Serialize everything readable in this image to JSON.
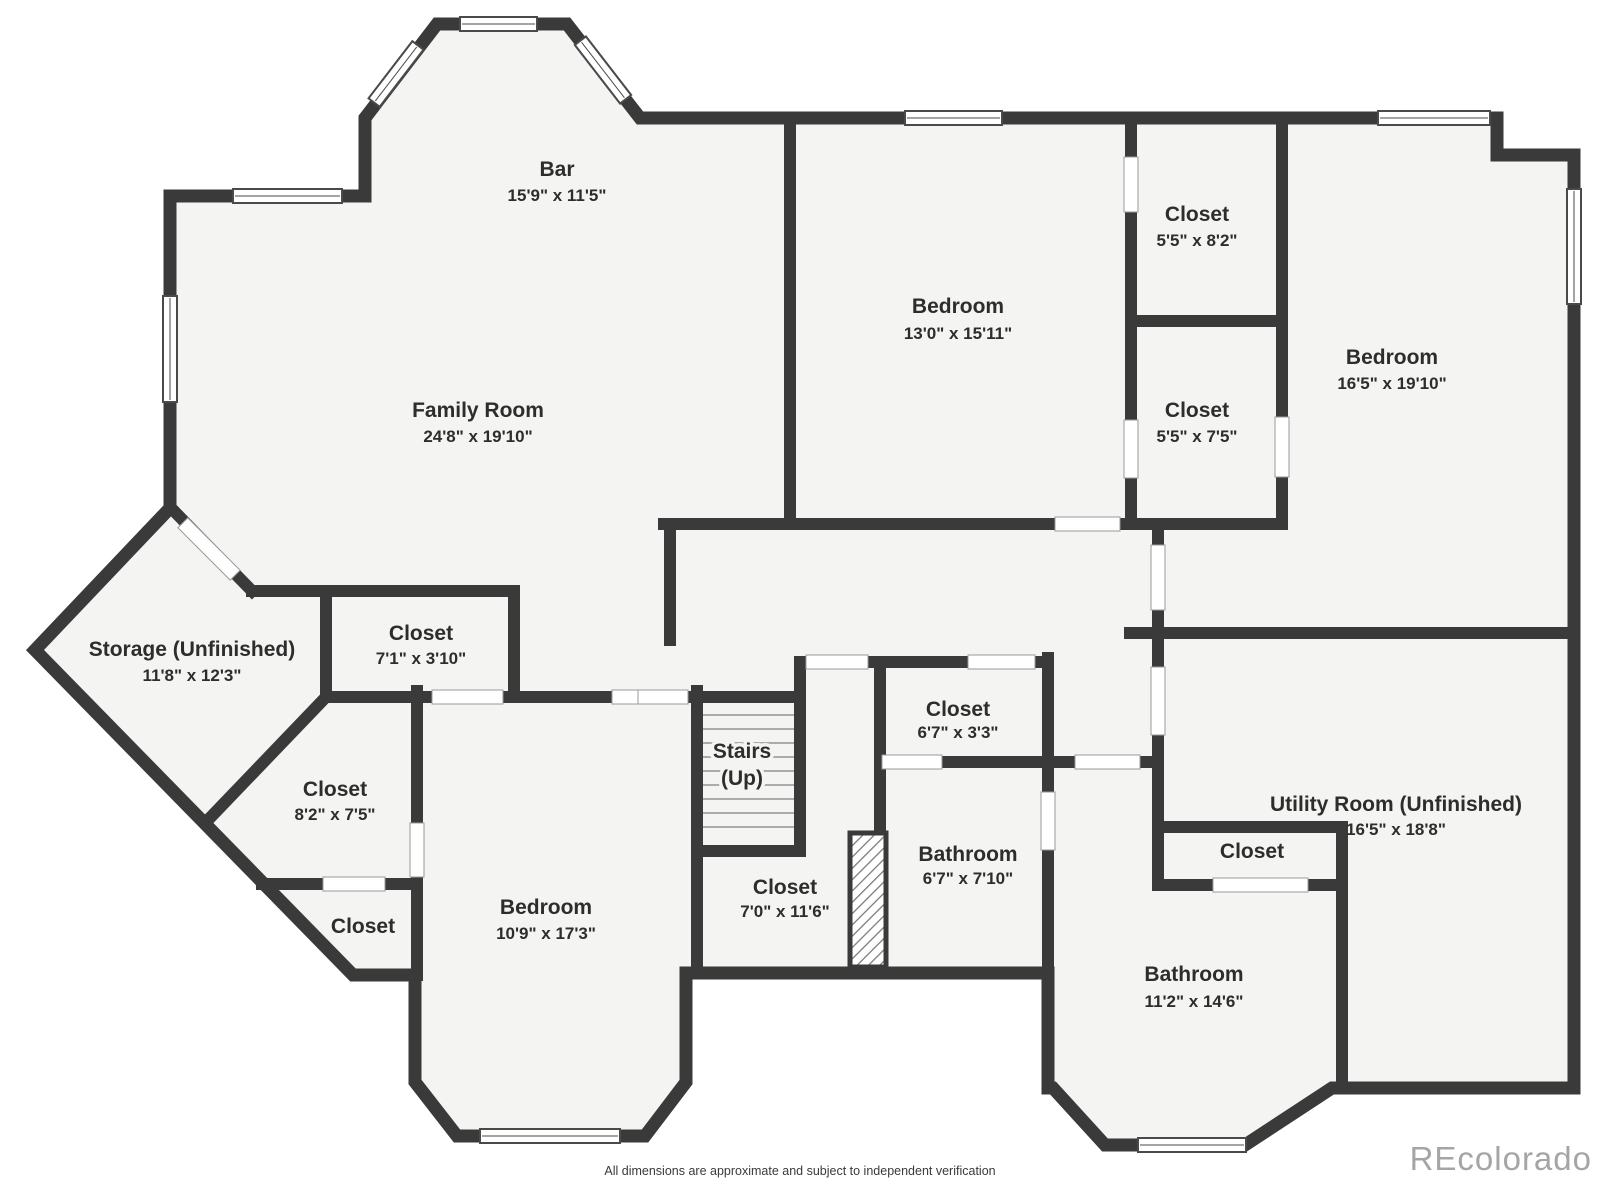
{
  "colors": {
    "wall": "#3a3a3a",
    "room_fill": "#f4f4f3",
    "background": "#ffffff",
    "label_text": "#2d2d2d",
    "watermark": "#a5a5a5"
  },
  "rooms": [
    {
      "id": "bar",
      "label": "Bar",
      "dims": "15'9\" x 11'5\""
    },
    {
      "id": "family-room",
      "label": "Family Room",
      "dims": "24'8\" x 19'10\""
    },
    {
      "id": "bedroom-middle",
      "label": "Bedroom",
      "dims": "13'0\" x 15'11\""
    },
    {
      "id": "closet-top-1",
      "label": "Closet",
      "dims": "5'5\" x 8'2\""
    },
    {
      "id": "closet-top-2",
      "label": "Closet",
      "dims": "5'5\" x 7'5\""
    },
    {
      "id": "bedroom-right",
      "label": "Bedroom",
      "dims": "16'5\" x 19'10\""
    },
    {
      "id": "storage",
      "label": "Storage (Unfinished)",
      "dims": "11'8\" x 12'3\""
    },
    {
      "id": "closet-71",
      "label": "Closet",
      "dims": "7'1\" x 3'10\""
    },
    {
      "id": "closet-82",
      "label": "Closet",
      "dims": "8'2\" x 7'5\""
    },
    {
      "id": "closet-small",
      "label": "Closet",
      "dims": ""
    },
    {
      "id": "bedroom-lower",
      "label": "Bedroom",
      "dims": "10'9\" x 17'3\""
    },
    {
      "id": "stairs",
      "label": "Stairs",
      "dims": "(Up)"
    },
    {
      "id": "closet-70",
      "label": "Closet",
      "dims": "7'0\" x 11'6\""
    },
    {
      "id": "closet-67",
      "label": "Closet",
      "dims": "6'7\" x 3'3\""
    },
    {
      "id": "bathroom-67",
      "label": "Bathroom",
      "dims": "6'7\" x 7'10\""
    },
    {
      "id": "utility-room",
      "label": "Utility Room (Unfinished)",
      "dims": "16'5\" x 18'8\""
    },
    {
      "id": "closet-utility",
      "label": "Closet",
      "dims": ""
    },
    {
      "id": "bathroom-112",
      "label": "Bathroom",
      "dims": "11'2\" x 14'6\""
    }
  ],
  "footer": {
    "disclaimer": "All dimensions are approximate and subject to independent verification"
  },
  "watermark": {
    "text": "REcolorado"
  }
}
